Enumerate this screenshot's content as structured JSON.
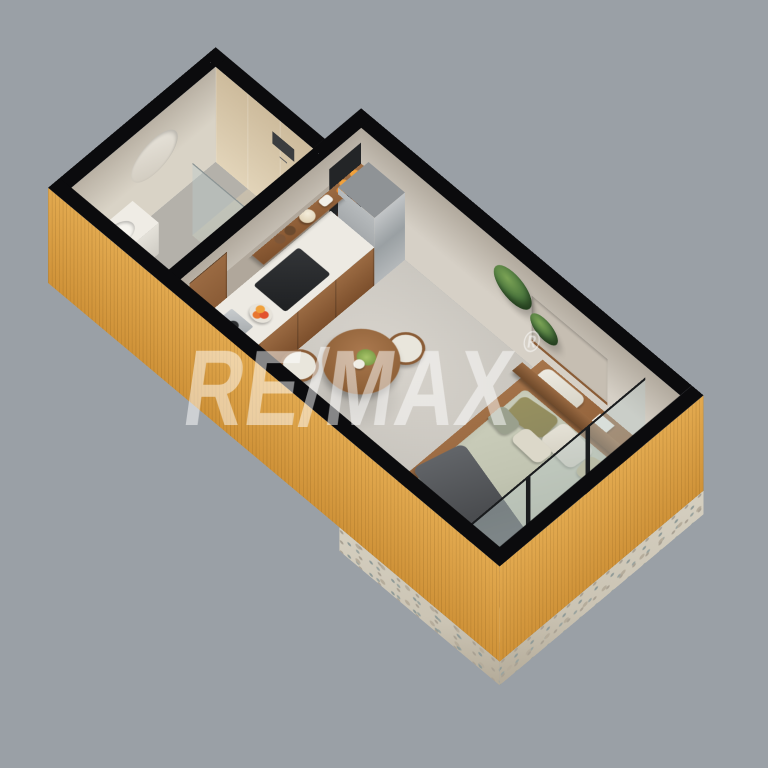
{
  "watermark": {
    "text": "RE/MAX",
    "registered": "®"
  },
  "scene": {
    "type": "isometric-3d-floorplan",
    "rooms": [
      "bathroom",
      "kitchen",
      "dining-living",
      "bedroom",
      "balcony"
    ]
  },
  "colors": {
    "bg": "#9aa0a6",
    "wallTop": "#0b0b0d",
    "frame": "#1a1c1e",
    "clad": "#e2a94f",
    "cladDeep": "#cf9238",
    "stone": "#cbc4b4",
    "greigeDark": "#b1a99d",
    "greige": "#d6d0c6",
    "travDark": "#cdbb9c",
    "trav": "#e2d4b9",
    "beige": "#d9d3c6",
    "floorLight": "#d7d3cc",
    "floor": "#c0bdb6",
    "bathFloor": "#b4b1aa",
    "balconyFloor": "#d8d2c5",
    "wood": "#9a6a42",
    "woodDark": "#6f4a2b",
    "counter": "#edeae3",
    "steel": "#a9adb0",
    "duvet": "#c2c5b2",
    "duvetShade": "#a8ab97",
    "throw": "#55575a",
    "pillowOlive": "#8f8a60",
    "pillowWhite": "#e6e3d8",
    "plant": "#47723b",
    "plantDark": "#2f5628",
    "glass": "rgba(186,202,202,0.42)",
    "accent": "#e07840"
  }
}
